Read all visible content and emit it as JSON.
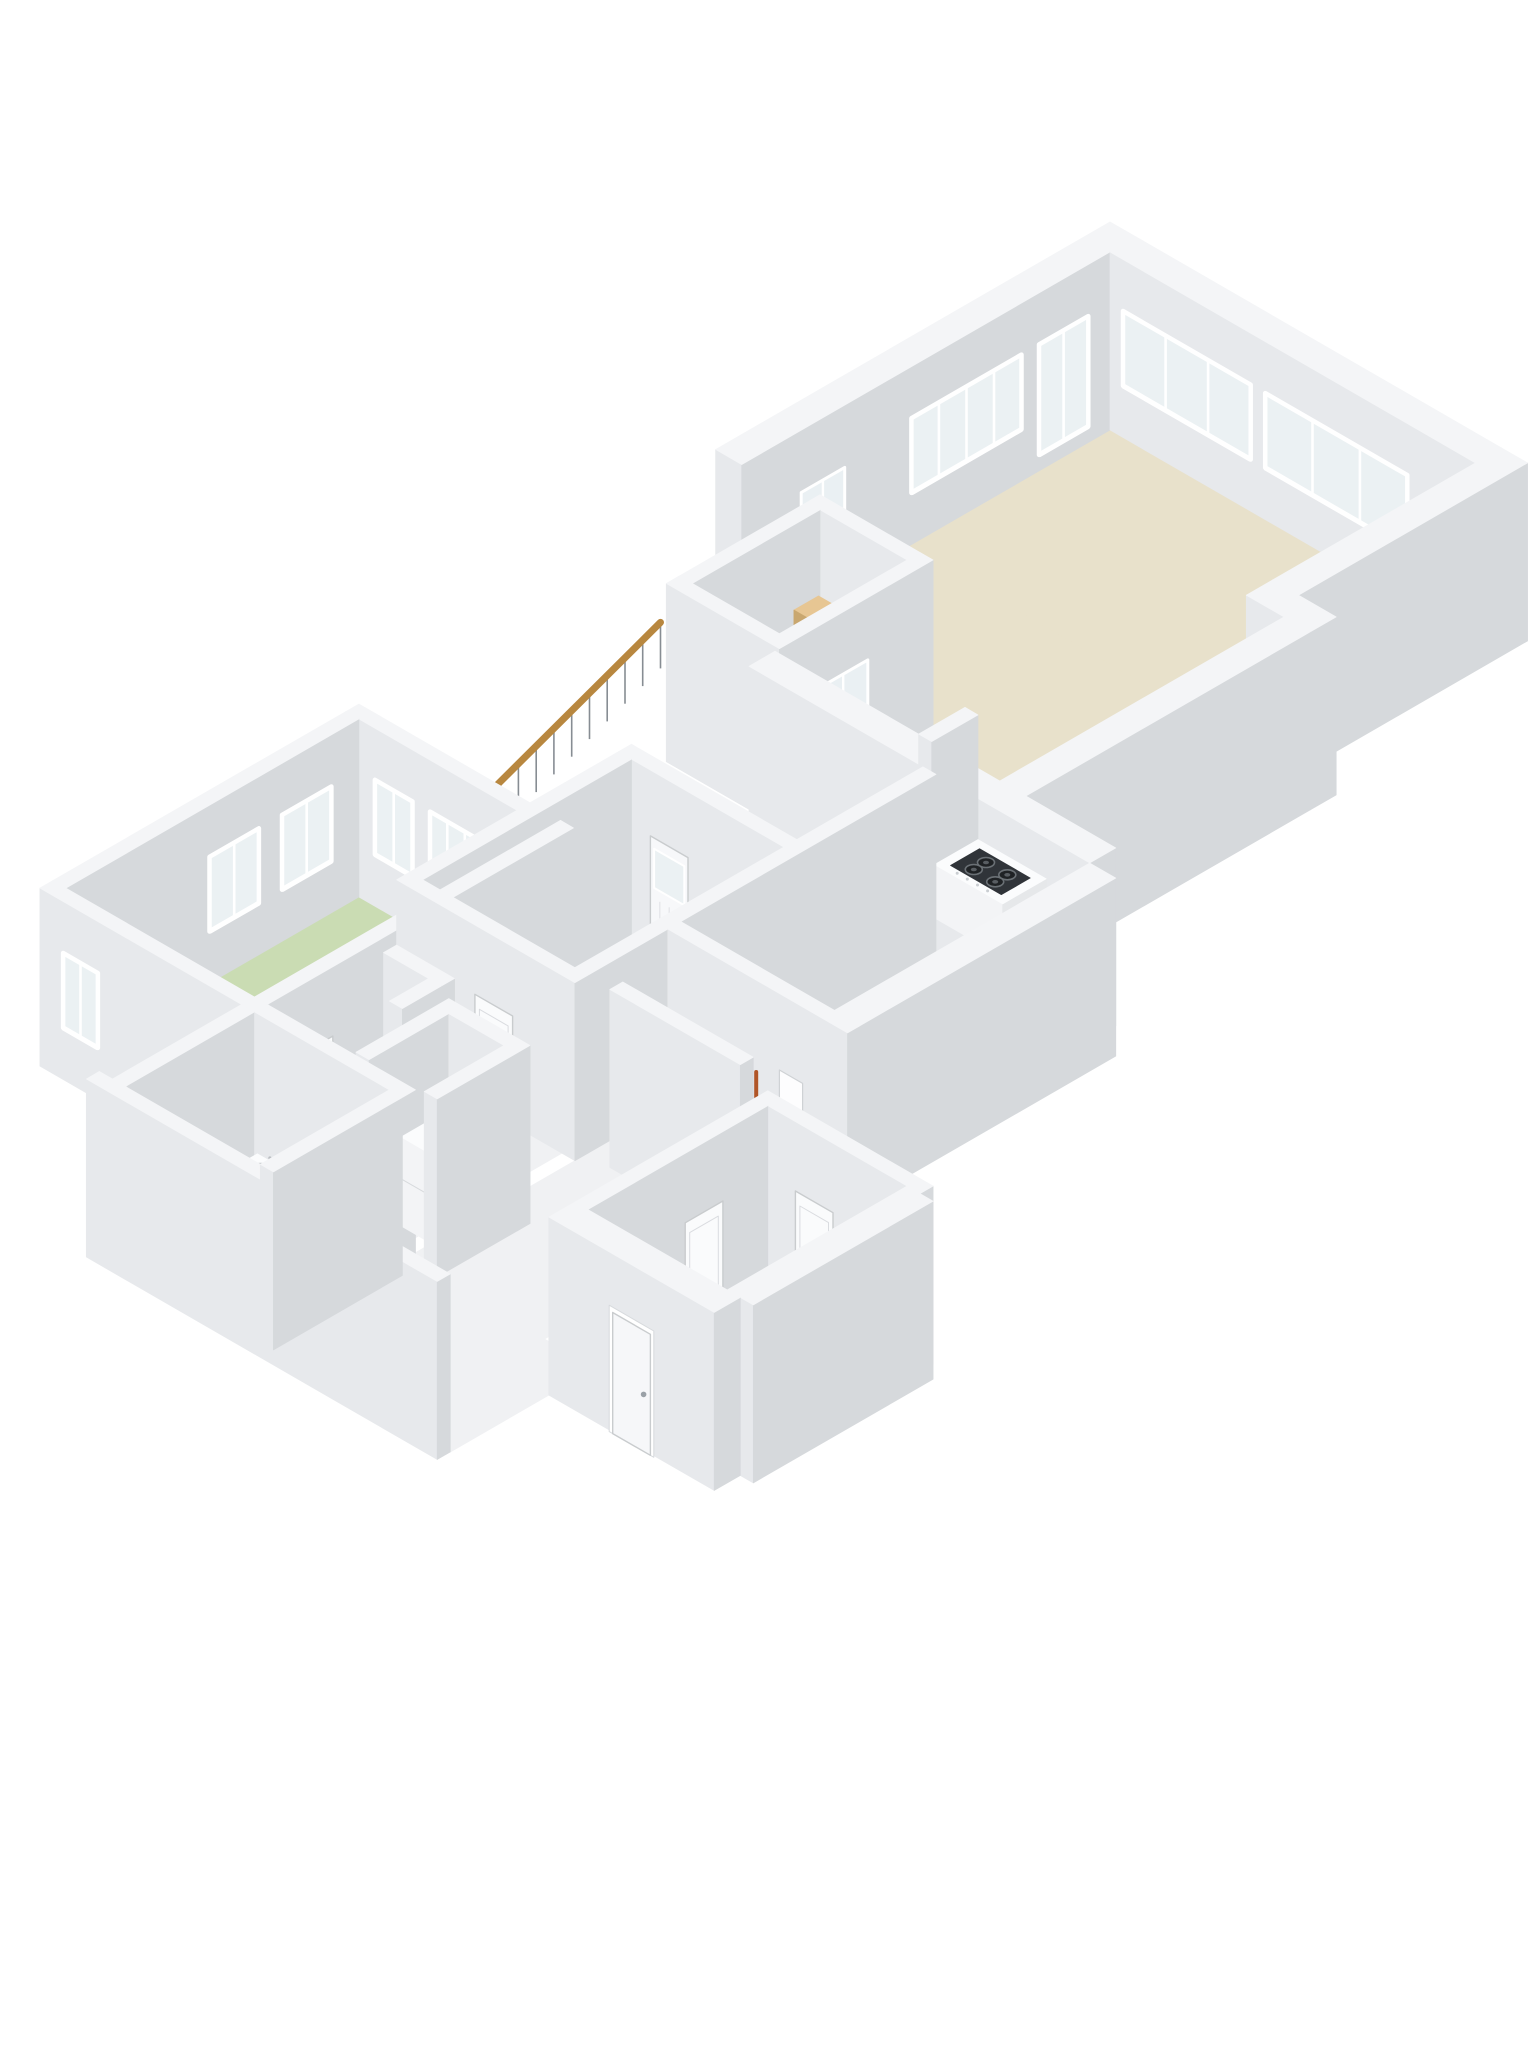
{
  "meta": {
    "description": "3D isometric floor plan rendering, first floor of a dwelling, white walls on white background",
    "visible_text": ""
  },
  "scene": {
    "w": 1536,
    "h": 2048,
    "ox": 1110,
    "oy": 430,
    "A": 29,
    "B": 16.74,
    "H": 178,
    "bg": "#ffffff"
  },
  "palette": {
    "wall_top": "#f4f5f7",
    "wall_faceV": "#e7e9ec",
    "wall_faceU": "#d6d9dc",
    "floor_beige": "#e8e1cb",
    "floor_green": "#cadcb3",
    "floor_blue": "#7e97b5",
    "floor_white": "#f0f1f3",
    "floor_gray": "#e2e4e6",
    "floor_stair": "#e1e3e6",
    "glass": "#ebf1f3",
    "frame": "#ffffff",
    "wood_rail": "#b8873f",
    "baluster": "#878d93",
    "stair_wood_a": "#e7c693",
    "stair_wood_b": "#dcb582",
    "stair_riser": "#c9a76f",
    "accent_red": "#c8373a",
    "appliance_dark": "#303439",
    "burner": "#1f2225",
    "burner_ring": "#6a7075",
    "fixture_top": "#fbfcfd",
    "fixture_faceV": "#f3f4f6",
    "fixture_faceU": "#e6e8ea",
    "door_leaf": "#fafbfc",
    "door_edge": "#c9ccce",
    "ski_dark": "#2b2d30",
    "ski_orange": "#b05527"
  },
  "floors": [
    {
      "n": "floor-living-room",
      "c": "floor_beige",
      "rect": [
        0,
        0,
        12.6,
        7
      ]
    },
    {
      "n": "floor-hallway",
      "c": "floor_beige",
      "poly": [
        [
          0,
          7
        ],
        [
          13.9,
          7
        ],
        [
          13.9,
          17.7
        ],
        [
          6.15,
          17.7
        ],
        [
          6.15,
          12.7
        ],
        [
          0,
          12.7
        ]
      ]
    },
    {
      "n": "floor-stairwell",
      "c": "floor_stair",
      "rect": [
        2.25,
        12.25,
        6.15,
        17.55
      ]
    },
    {
      "n": "floor-room-right",
      "c": "floor_gray",
      "rect": [
        12.6,
        18.6,
        17.9,
        27.4
      ]
    },
    {
      "n": "floor-bedroom-middle",
      "c": "floor_green",
      "rect": [
        6.9,
        23.4,
        12.6,
        30.6
      ]
    },
    {
      "n": "floor-bedroom-left",
      "c": "floor_green",
      "rect": [
        1.0,
        26.9,
        7.5,
        37.0
      ]
    },
    {
      "n": "floor-corridor",
      "c": "floor_white",
      "rect": [
        7.95,
        31.05,
        12.15,
        37.0
      ]
    },
    {
      "n": "floor-room-small",
      "c": "floor_white",
      "rect": [
        12.6,
        27.85,
        17.4,
        36.9
      ]
    },
    {
      "n": "floor-bathroom",
      "c": "floor_blue",
      "rect": [
        7.95,
        37.45,
        12.6,
        41.9
      ]
    },
    {
      "n": "floor-corridor-2",
      "c": "floor_white",
      "rect": [
        13.05,
        36.9,
        19.15,
        41.9
      ]
    },
    {
      "n": "floor-entry-room",
      "c": "floor_white",
      "rect": [
        19.6,
        31.4,
        24.4,
        37.6
      ]
    }
  ],
  "items": [
    {
      "k": "wall",
      "n": "wall-exterior-left-top",
      "d": -1.8,
      "b": [
        -0.9,
        -0.9,
        0,
        12.7
      ],
      "ov": [
        {
          "t": "win",
          "f": "u",
          "a": 0.8,
          "b": 2.5,
          "z0": 0.1,
          "z1": 0.72,
          "L": 2
        },
        {
          "t": "win",
          "f": "u",
          "a": 3.1,
          "b": 6.9,
          "z0": 0.3,
          "z1": 0.72,
          "L": 4
        },
        {
          "t": "gdoor",
          "f": "u",
          "a": 9.2,
          "b": 10.7
        }
      ]
    },
    {
      "k": "wall",
      "n": "wall-exterior-top-right",
      "d": -0.9,
      "b": [
        0,
        -0.9,
        12.6,
        0
      ],
      "ov": [
        {
          "t": "win",
          "f": "v",
          "a": 0.5,
          "b": 4.9,
          "z0": 0.3,
          "z1": 0.72,
          "L": 3
        },
        {
          "t": "win",
          "f": "v",
          "a": 5.4,
          "b": 10.3,
          "z0": 0.3,
          "z1": 0.72,
          "L": 3
        }
      ]
    },
    {
      "k": "wall",
      "n": "wall-exterior-right",
      "d": 11.7,
      "b": [
        12.6,
        -0.9,
        13.5,
        7
      ]
    },
    {
      "k": "wall",
      "n": "wall-stairwell-north",
      "d": 14.5,
      "b": [
        2.25,
        12.25,
        6.15,
        12.7
      ]
    },
    {
      "k": "wall",
      "n": "wall-stairwell-west",
      "d": 14.95,
      "b": [
        2.25,
        12.7,
        2.7,
        17.55
      ]
    },
    {
      "k": "stairs",
      "n": "staircase-winding",
      "d": 15.5,
      "u0": 2.8,
      "u1": 5.55,
      "v0": 12.85,
      "dv": 0.85,
      "z0": 0.54,
      "dz": 0.105,
      "steps": 5
    },
    {
      "k": "red",
      "n": "stair-red-handrail-detail",
      "d": 15.9,
      "pts": [
        [
          5.35,
          13.0,
          0.52
        ],
        [
          5.42,
          13.8,
          0.4
        ]
      ]
    },
    {
      "k": "wall",
      "n": "wall-stairwell-east",
      "d": 17.95,
      "b": [
        5.7,
        12.25,
        6.15,
        17.1
      ],
      "ov": [
        {
          "t": "gdoor",
          "f": "u",
          "a": 14.55,
          "b": 16.25,
          "hint": true
        }
      ]
    },
    {
      "k": "wall",
      "n": "wall-stairwell-south",
      "d": 19.35,
      "b": [
        2.25,
        17.1,
        6.15,
        17.55
      ]
    },
    {
      "k": "wall",
      "n": "wall-step-out",
      "d": 19.6,
      "b": [
        12.6,
        7,
        14.8,
        7.9
      ]
    },
    {
      "k": "railing",
      "n": 13,
      "d": 20.1,
      "u": 2.25,
      "v0": 17.75,
      "v1": 25.1,
      "z0": 0.8,
      "z1": 0.3
    },
    {
      "k": "wall",
      "n": "wall-hall-east",
      "d": 21.8,
      "b": [
        13.9,
        7.9,
        14.8,
        18.6
      ]
    },
    {
      "k": "wall",
      "n": "wall-hall-south",
      "d": 23.85,
      "b": [
        6.15,
        17.7,
        17.9,
        18.6
      ],
      "ov": [
        {
          "t": "door",
          "f": "v",
          "a": 14.9,
          "b": 16.2
        }
      ]
    },
    {
      "k": "wall",
      "n": "wall-bedroom-left-north",
      "d": 27.0,
      "b": [
        0.55,
        26.45,
        7.95,
        26.9
      ],
      "ov": [
        {
          "t": "win",
          "f": "v",
          "a": 1.6,
          "b": 2.9,
          "z0": 0.3,
          "z1": 0.72,
          "L": 2
        },
        {
          "t": "win",
          "f": "v",
          "a": 3.5,
          "b": 5.3,
          "z0": 0.1,
          "z1": 0.72,
          "L": 3
        },
        {
          "t": "win",
          "f": "v",
          "a": 5.9,
          "b": 7.1,
          "z0": 0.3,
          "z1": 0.72,
          "L": 2
        }
      ]
    },
    {
      "k": "wall",
      "n": "wall-niche-side",
      "d": 27.2,
      "b": [
        11.1,
        16.1,
        11.55,
        17.7
      ]
    },
    {
      "k": "wall",
      "n": "wall-bedroom-left-west",
      "d": 27.45,
      "b": [
        0.55,
        26.9,
        1.0,
        37.0
      ],
      "ov": [
        {
          "t": "win",
          "f": "u",
          "a": 27.9,
          "b": 29.6,
          "z0": 0.3,
          "z1": 0.72,
          "L": 2
        },
        {
          "t": "win",
          "f": "u",
          "a": 30.4,
          "b": 32.1,
          "z0": 0.3,
          "z1": 0.72,
          "L": 2
        }
      ]
    },
    {
      "k": "boxf",
      "n": "kitchen-stove-counter",
      "d": 27.65,
      "b": [
        11.55,
        16.1,
        13.9,
        17.6
      ],
      "h": 0.3,
      "top": "hob"
    },
    {
      "k": "wall",
      "n": "wall-bedroom-middle-north",
      "d": 29.4,
      "b": [
        6.45,
        22.95,
        12.6,
        23.4
      ],
      "ov": [
        {
          "t": "pdoor",
          "f": "v",
          "a": 7.6,
          "b": 8.9
        }
      ]
    },
    {
      "k": "wall",
      "n": "wall-bedroom-middle-west",
      "d": 29.85,
      "b": [
        6.45,
        23.4,
        6.9,
        30.6
      ]
    },
    {
      "k": "wall",
      "n": "wall-room-right-west",
      "d": 30.75,
      "b": [
        12.15,
        18.6,
        12.6,
        30.6
      ]
    },
    {
      "k": "wall",
      "n": "wall-bedroom-left-east",
      "d": 33.95,
      "b": [
        7.5,
        26.45,
        7.95,
        37.0
      ],
      "ov": [
        {
          "t": "door",
          "f": "u",
          "a": 34.8,
          "b": 36.1
        }
      ]
    },
    {
      "k": "wall",
      "n": "wall-room-right-east",
      "d": 36.5,
      "b": [
        17.9,
        18.6,
        18.8,
        27.85
      ]
    },
    {
      "k": "wall",
      "n": "wall-bedroom-middle-south",
      "d": 37.05,
      "b": [
        6.45,
        30.6,
        12.6,
        31.05
      ],
      "ov": [
        {
          "t": "door",
          "f": "v",
          "a": 9.2,
          "b": 10.5
        }
      ]
    },
    {
      "k": "wall",
      "n": "wall-bedroom-left-south",
      "d": 37.55,
      "b": [
        0.55,
        37.0,
        7.95,
        37.45
      ],
      "ov": [
        {
          "t": "win",
          "f": "v",
          "a": 1.4,
          "b": 2.6,
          "z0": 0.3,
          "z1": 0.72,
          "L": 2
        },
        {
          "t": "door",
          "f": "v",
          "a": 6.6,
          "b": 7.9
        }
      ]
    },
    {
      "k": "wall",
      "n": "wall-room-right-south",
      "d": 40.0,
      "b": [
        12.6,
        27.4,
        18.8,
        27.85
      ],
      "ov": [
        {
          "t": "panel",
          "f": "v",
          "a": 16.5,
          "b": 17.3
        }
      ]
    },
    {
      "k": "wall",
      "n": "wall-closet-small-north",
      "d": 41.4,
      "b": [
        8.4,
        33.0,
        10.4,
        33.45
      ]
    },
    {
      "k": "bars",
      "n": "storage-skis",
      "d": 42.4,
      "v": 28.2,
      "h": 0.55,
      "us": [
        14.2,
        14.75,
        15.3,
        16.0
      ],
      "colors": [
        "ski_dark",
        "ski_dark",
        "ski_dark",
        "ski_orange"
      ]
    },
    {
      "k": "wall",
      "n": "wall-closet-small-east",
      "d": 43.4,
      "b": [
        9.95,
        33.45,
        10.4,
        34.8
      ]
    },
    {
      "k": "wall",
      "n": "wall-ski-closet-south",
      "d": 43.6,
      "b": [
        13.4,
        30.2,
        17.9,
        30.65
      ]
    },
    {
      "k": "wall",
      "n": "wall-heater-closet-west",
      "d": 44.6,
      "b": [
        10.9,
        33.7,
        11.35,
        36.9
      ]
    },
    {
      "k": "wall",
      "n": "wall-bathroom-west",
      "d": 44.95,
      "b": [
        7.5,
        37.45,
        7.95,
        41.9
      ]
    },
    {
      "k": "wall",
      "n": "wall-bathroom-north",
      "d": 44.96,
      "b": [
        7.95,
        37.0,
        13.05,
        37.45
      ],
      "ov": [
        {
          "t": "door",
          "f": "v",
          "a": 10.9,
          "b": 12.2
        }
      ]
    },
    {
      "k": "wall",
      "n": "wall-heater-closet-north",
      "d": 45.05,
      "b": [
        11.35,
        33.7,
        13.7,
        34.15
      ]
    },
    {
      "k": "boxf",
      "n": "water-heater-unit",
      "d": 45.95,
      "b": [
        11.55,
        34.4,
        12.95,
        36.0
      ],
      "h": 0.5,
      "top": "boiler"
    },
    {
      "k": "boxf",
      "n": "bathroom-sink",
      "d": 46.0,
      "b": [
        8.3,
        37.7,
        9.4,
        38.6
      ],
      "h": 0.26,
      "top": "sink"
    },
    {
      "k": "wall",
      "n": "wall-heater-closet-east",
      "d": 46.95,
      "b": [
        13.25,
        33.7,
        13.7,
        36.9
      ]
    },
    {
      "k": "wall",
      "n": "wall-bottom-exterior",
      "d": 48.95,
      "b": [
        7.05,
        41.9,
        19.15,
        42.35
      ]
    },
    {
      "k": "wall",
      "n": "wall-bathroom-east",
      "d": 50.05,
      "b": [
        12.6,
        37.45,
        13.05,
        41.9
      ]
    },
    {
      "k": "wall",
      "n": "wall-entry-room-north",
      "d": 50.1,
      "b": [
        19.15,
        30.95,
        24.85,
        31.4
      ],
      "ov": [
        {
          "t": "door",
          "f": "v",
          "a": 20.6,
          "b": 21.9
        }
      ]
    },
    {
      "k": "wall",
      "n": "wall-entry-room-west",
      "d": 50.55,
      "b": [
        19.15,
        31.4,
        19.6,
        37.6
      ],
      "ov": [
        {
          "t": "door",
          "f": "u",
          "a": 33.0,
          "b": 34.3
        }
      ]
    },
    {
      "k": "wall",
      "n": "wall-entry-room-east",
      "d": 55.8,
      "b": [
        24.4,
        31.4,
        25.3,
        37.6
      ]
    },
    {
      "k": "wall",
      "n": "wall-front-exterior",
      "d": 56.75,
      "b": [
        19.15,
        37.6,
        24.85,
        38.5
      ],
      "ov": [
        {
          "t": "fdoor",
          "f": "v",
          "a": 21.4,
          "b": 22.7
        }
      ]
    }
  ]
}
